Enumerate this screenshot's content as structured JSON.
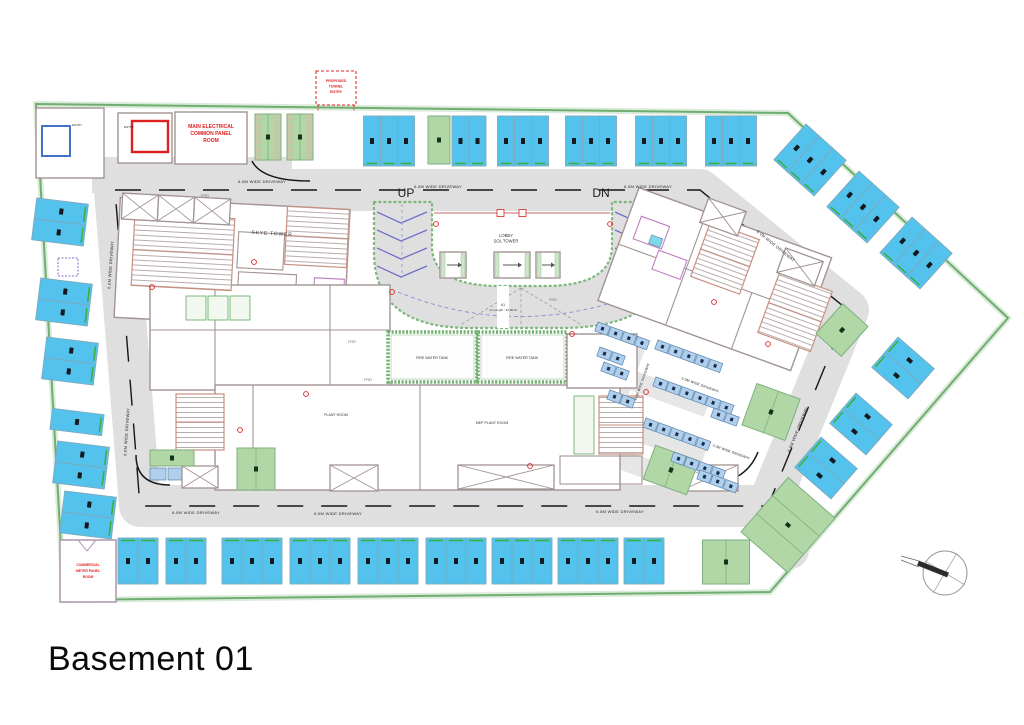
{
  "title": {
    "text": "Basement 01"
  },
  "labels": {
    "up": "UP",
    "dn": "DN",
    "d6": "6.0M WIDE DRIVEWAY",
    "d3": "3.0M WIDE DRIVEWAY",
    "frd": "FRD",
    "tunnel1": "PROPOSED",
    "tunnel2": "TUNNEL",
    "tunnel3": "ENTRY",
    "elec1": "MAIN ELECTRICAL",
    "elec2": "COMMON PANEL",
    "elec3": "ROOM",
    "comm1": "COMMERCIAL",
    "comm2": "METER PANEL",
    "comm3": "ROOM",
    "entry": "ENTRY",
    "skye": "SKYE TOWER",
    "lobby1": "LOBBY",
    "lobby2": "SOL TOWER",
    "tank": "FIRE WATER TANK",
    "plant": "PLANT ROOM",
    "mep": "MEP PLANT ROOM",
    "rampA": "A1",
    "rampLen": "CL Length : 46.00 M"
  },
  "colors": {
    "stall_blue": "#53C3EE",
    "stall_sep": "#7FA8BC",
    "tick_green": "#3FAF3F",
    "green": "#B2D7A6",
    "green_border": "#7FAF7F",
    "bike_fill": "#AFCFEC",
    "bike_border": "#5B84AC",
    "driveway": "#DFDFDF",
    "boundary": "#6FAE6F",
    "wall": "#A39393",
    "stair_border": "#C89080",
    "red": "#E02020",
    "pink": "#C080C0",
    "chevron": "#7070C8",
    "number_dark": "#15181C"
  },
  "plan_geometry": {
    "stall_groups": [
      {
        "cx": 389,
        "cy": 141,
        "angle": 0,
        "count": 3,
        "sw": 17,
        "depth": 50,
        "dir": "h",
        "tick": "end"
      },
      {
        "cx": 469,
        "cy": 141,
        "angle": 0,
        "count": 2,
        "sw": 17,
        "depth": 50,
        "dir": "h",
        "tick": "end"
      },
      {
        "cx": 523,
        "cy": 141,
        "angle": 0,
        "count": 3,
        "sw": 17,
        "depth": 50,
        "dir": "h",
        "tick": "end"
      },
      {
        "cx": 591,
        "cy": 141,
        "angle": 0,
        "count": 3,
        "sw": 17,
        "depth": 50,
        "dir": "h",
        "tick": "end"
      },
      {
        "cx": 661,
        "cy": 141,
        "angle": 0,
        "count": 3,
        "sw": 17,
        "depth": 50,
        "dir": "h",
        "tick": "end"
      },
      {
        "cx": 731,
        "cy": 141,
        "angle": 0,
        "count": 3,
        "sw": 17,
        "depth": 50,
        "dir": "h",
        "tick": "end"
      },
      {
        "cx": 810,
        "cy": 160,
        "angle": 42,
        "count": 3,
        "sw": 18,
        "depth": 48,
        "dir": "h",
        "tick": "end"
      },
      {
        "cx": 863,
        "cy": 207,
        "angle": 42,
        "count": 3,
        "sw": 18,
        "depth": 48,
        "dir": "h",
        "tick": "end"
      },
      {
        "cx": 916,
        "cy": 253,
        "angle": 42,
        "count": 3,
        "sw": 18,
        "depth": 48,
        "dir": "h",
        "tick": "end"
      },
      {
        "cx": 903,
        "cy": 368,
        "angle": -49,
        "count": 2,
        "sw": 20,
        "depth": 48,
        "dir": "h",
        "tick": "start"
      },
      {
        "cx": 861,
        "cy": 424,
        "angle": -49,
        "count": 2,
        "sw": 20,
        "depth": 48,
        "dir": "h",
        "tick": "start"
      },
      {
        "cx": 826,
        "cy": 468,
        "angle": -49,
        "count": 2,
        "sw": 20,
        "depth": 48,
        "dir": "h",
        "tick": "start"
      },
      {
        "cx": 138,
        "cy": 561,
        "angle": 0,
        "count": 2,
        "sw": 20,
        "depth": 46,
        "dir": "h",
        "tick": "start"
      },
      {
        "cx": 186,
        "cy": 561,
        "angle": 0,
        "count": 2,
        "sw": 20,
        "depth": 46,
        "dir": "h",
        "tick": "start"
      },
      {
        "cx": 252,
        "cy": 561,
        "angle": 0,
        "count": 3,
        "sw": 20,
        "depth": 46,
        "dir": "h",
        "tick": "start"
      },
      {
        "cx": 320,
        "cy": 561,
        "angle": 0,
        "count": 3,
        "sw": 20,
        "depth": 46,
        "dir": "h",
        "tick": "start"
      },
      {
        "cx": 388,
        "cy": 561,
        "angle": 0,
        "count": 3,
        "sw": 20,
        "depth": 46,
        "dir": "h",
        "tick": "start"
      },
      {
        "cx": 456,
        "cy": 561,
        "angle": 0,
        "count": 3,
        "sw": 20,
        "depth": 46,
        "dir": "h",
        "tick": "start"
      },
      {
        "cx": 522,
        "cy": 561,
        "angle": 0,
        "count": 3,
        "sw": 20,
        "depth": 46,
        "dir": "h",
        "tick": "start"
      },
      {
        "cx": 588,
        "cy": 561,
        "angle": 0,
        "count": 3,
        "sw": 20,
        "depth": 46,
        "dir": "h",
        "tick": "start"
      },
      {
        "cx": 644,
        "cy": 561,
        "angle": 0,
        "count": 2,
        "sw": 20,
        "depth": 46,
        "dir": "h",
        "tick": "start"
      },
      {
        "cx": 60,
        "cy": 222,
        "angle": 7,
        "count": 2,
        "sw": 21,
        "depth": 52,
        "dir": "v",
        "tick": "end"
      },
      {
        "cx": 64,
        "cy": 302,
        "angle": 7,
        "count": 2,
        "sw": 21,
        "depth": 52,
        "dir": "v",
        "tick": "end"
      },
      {
        "cx": 70,
        "cy": 361,
        "angle": 7,
        "count": 2,
        "sw": 21,
        "depth": 52,
        "dir": "v",
        "tick": "end"
      },
      {
        "cx": 77,
        "cy": 422,
        "angle": 7,
        "count": 1,
        "sw": 21,
        "depth": 52,
        "dir": "v",
        "tick": "end"
      },
      {
        "cx": 81,
        "cy": 465,
        "angle": 7,
        "count": 2,
        "sw": 21,
        "depth": 52,
        "dir": "v",
        "tick": "end"
      },
      {
        "cx": 88,
        "cy": 515,
        "angle": 7,
        "count": 2,
        "sw": 21,
        "depth": 52,
        "dir": "v",
        "tick": "end"
      }
    ],
    "green_stalls": [
      {
        "cx": 439,
        "cy": 140,
        "w": 22,
        "h": 48,
        "angle": 0,
        "divs": 0,
        "hatch": false
      },
      {
        "cx": 268,
        "cy": 137,
        "w": 26,
        "h": 46,
        "angle": 0,
        "divs": 1,
        "hatch": true
      },
      {
        "cx": 300,
        "cy": 137,
        "w": 26,
        "h": 46,
        "angle": 0,
        "divs": 1,
        "hatch": true
      },
      {
        "cx": 256,
        "cy": 469,
        "w": 38,
        "h": 42,
        "angle": 0,
        "divs": 1,
        "hatch": false
      },
      {
        "cx": 172,
        "cy": 458,
        "w": 44,
        "h": 16,
        "angle": 0,
        "divs": 0,
        "hatch": false
      },
      {
        "cx": 671,
        "cy": 470,
        "w": 46,
        "h": 36,
        "angle": 20,
        "divs": 1,
        "hatch": false
      },
      {
        "cx": 771,
        "cy": 412,
        "w": 46,
        "h": 44,
        "angle": 20,
        "divs": 1,
        "hatch": false
      },
      {
        "cx": 842,
        "cy": 330,
        "w": 34,
        "h": 40,
        "angle": 42,
        "divs": 0,
        "hatch": false
      },
      {
        "cx": 788,
        "cy": 525,
        "w": 72,
        "h": 62,
        "angle": -49,
        "divs": 2,
        "hatch": false
      },
      {
        "cx": 726,
        "cy": 562,
        "w": 47,
        "h": 44,
        "angle": 0,
        "divs": 1,
        "hatch": false
      }
    ],
    "bike_rows": [
      {
        "x": 598,
        "y": 322,
        "angle": 20,
        "count": 4
      },
      {
        "x": 600,
        "y": 347,
        "angle": 20,
        "count": 2
      },
      {
        "x": 658,
        "y": 340,
        "angle": 20,
        "count": 5
      },
      {
        "x": 656,
        "y": 377,
        "angle": 20,
        "count": 6
      },
      {
        "x": 646,
        "y": 418,
        "angle": 20,
        "count": 5
      },
      {
        "x": 674,
        "y": 452,
        "angle": 20,
        "count": 4
      },
      {
        "x": 714,
        "y": 408,
        "angle": 20,
        "count": 2
      },
      {
        "x": 604,
        "y": 362,
        "angle": 20,
        "count": 2
      },
      {
        "x": 610,
        "y": 390,
        "angle": 20,
        "count": 2
      },
      {
        "x": 700,
        "y": 470,
        "angle": 20,
        "count": 3
      }
    ],
    "void_boxes": [
      {
        "cx": 140,
        "cy": 207,
        "w": 36,
        "h": 26,
        "angle": 3
      },
      {
        "cx": 176,
        "cy": 209,
        "w": 36,
        "h": 26,
        "angle": 3
      },
      {
        "cx": 212,
        "cy": 211,
        "w": 36,
        "h": 26,
        "angle": 3
      },
      {
        "cx": 723,
        "cy": 217,
        "w": 40,
        "h": 26,
        "angle": 20
      },
      {
        "cx": 800,
        "cy": 267,
        "w": 40,
        "h": 26,
        "angle": 20
      },
      {
        "cx": 200,
        "cy": 477,
        "w": 36,
        "h": 22,
        "angle": 0
      },
      {
        "cx": 354,
        "cy": 478,
        "w": 48,
        "h": 26,
        "angle": 0
      },
      {
        "cx": 506,
        "cy": 477,
        "w": 96,
        "h": 24,
        "angle": 0
      },
      {
        "cx": 709,
        "cy": 478,
        "w": 58,
        "h": 26,
        "angle": 0
      }
    ],
    "stair_cores": [
      {
        "cx": 183,
        "cy": 252,
        "w": 100,
        "h": 72,
        "angle": 3
      },
      {
        "cx": 317,
        "cy": 237,
        "w": 62,
        "h": 58,
        "angle": 3
      },
      {
        "cx": 200,
        "cy": 422,
        "w": 48,
        "h": 56,
        "angle": 0
      },
      {
        "cx": 621,
        "cy": 425,
        "w": 44,
        "h": 58,
        "angle": 0
      },
      {
        "cx": 725,
        "cy": 258,
        "w": 52,
        "h": 58,
        "angle": 20
      },
      {
        "cx": 795,
        "cy": 312,
        "w": 56,
        "h": 64,
        "angle": 20
      }
    ],
    "markers": [
      [
        152,
        287
      ],
      [
        254,
        262
      ],
      [
        392,
        292
      ],
      [
        436,
        224
      ],
      [
        610,
        224
      ],
      [
        572,
        334
      ],
      [
        646,
        392
      ],
      [
        714,
        302
      ],
      [
        768,
        344
      ],
      [
        306,
        394
      ],
      [
        240,
        430
      ],
      [
        530,
        466
      ]
    ]
  }
}
